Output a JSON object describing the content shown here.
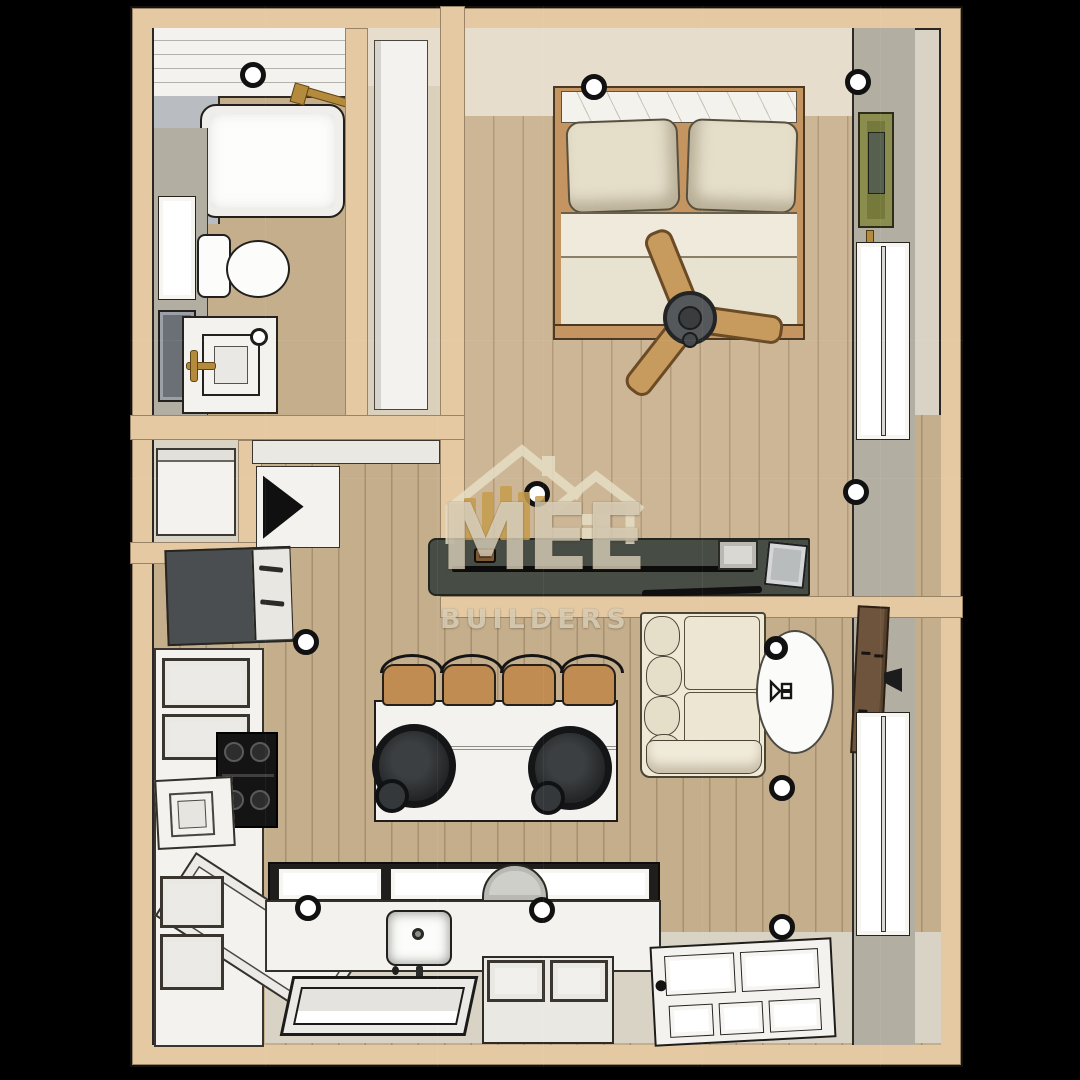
{
  "scene": {
    "type": "3d-rendered-floor-plan",
    "view": "top-down",
    "background": "black",
    "unit": "studio-apartment"
  },
  "watermark": {
    "brand": "MEE",
    "tagline": "BUILDERS",
    "logo": "house-outline-with-lumber-planks"
  },
  "palette": {
    "background": "#000000",
    "wall": "#e5c9a2",
    "wood": "#c5ae8c",
    "wood_bed": "#ccb695",
    "cream": "#e6ddcc",
    "greige": "#d9d3c5",
    "gray_wall": "#b2afa2",
    "shower_gray": "#b9bdc2",
    "white": "#f3f2ef",
    "off_white": "#e9e8e3",
    "appliance_dark": "#4a4e51",
    "console": "#474c44",
    "stool": "#c18c52",
    "gold": "#b48a3c",
    "green_frame": "#76793c",
    "brown_panel": "#6e543c",
    "sofa": "#efe9d6",
    "sofa2": "#e5dec9",
    "watermark_cream": "#e7dfc6"
  },
  "rooms": {
    "bathroom": {
      "items": [
        "bathtub",
        "gold-shower-fixture",
        "toilet",
        "vanity-with-sink",
        "gold-faucet",
        "wall-window",
        "wall-mirror",
        "recessed-light"
      ]
    },
    "closet": {
      "items": [
        "tall-wardrobe"
      ]
    },
    "bedroom": {
      "items": [
        "wood-frame-bed",
        "pillow",
        "pillow",
        "ceiling-fan-3-blade",
        "media-console",
        "flat-tv",
        "storage-basket",
        "waste-bin",
        "green-picture-frame",
        "double-hung-window",
        "recessed-lights"
      ]
    },
    "laundry_nook": {
      "items": [
        "washer-appliance"
      ]
    },
    "kitchen": {
      "items": [
        "refrigerator",
        "corner-hood-cabinet",
        "gas-cooktop-4-burner",
        "upper-cabinets",
        "base-cabinets",
        "angled-corner-counter",
        "small-appliance",
        "island-counter",
        "bar-stool",
        "bar-stool",
        "bar-stool",
        "bar-stool",
        "pendant-light",
        "pendant-light",
        "kitchen-sink",
        "faucet",
        "window-row",
        "dish-arch",
        "south-window",
        "storage-bench"
      ]
    },
    "living_room": {
      "items": [
        "cream-sofa",
        "oval-side-table",
        "black-bowl",
        "table-sculpture",
        "wall-mounted-brown-panel",
        "wall-bracket",
        "double-hung-window",
        "glazed-entry-door",
        "recessed-lights"
      ]
    }
  },
  "counts": {
    "bar_stools": 4,
    "pendant_lights": 2,
    "recessed_lights": 10,
    "fan_blades": 3
  }
}
